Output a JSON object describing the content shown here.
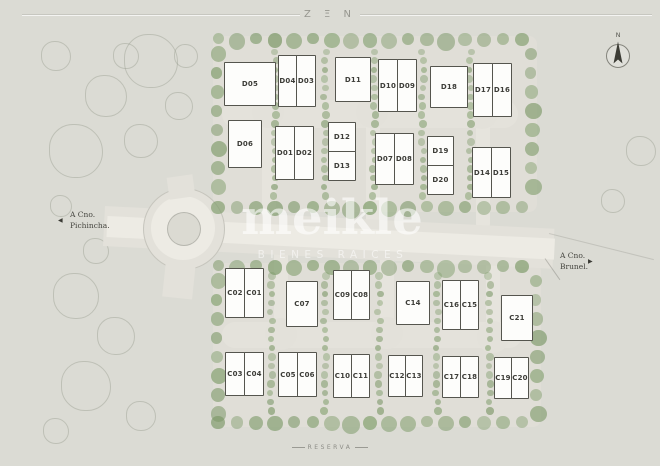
{
  "frame": {
    "top_title": "Z Ξ N",
    "bottom_title": "RESERVA"
  },
  "watermark": {
    "name": "meikle",
    "tagline": "BIENES RAICES"
  },
  "roads": {
    "west": {
      "line1": "A Cno.",
      "line2": "Pichincha.",
      "arrow": "◀"
    },
    "east": {
      "line1": "A Cno.",
      "line2": "Brunel.",
      "arrow": "▶"
    }
  },
  "compass": {
    "label": "N"
  },
  "colors": {
    "background": "#dbdbd4",
    "block": "#e0ded7",
    "road": "#edebe4",
    "tree": "#96a37c",
    "house_fill": "#fdfdfb",
    "house_stroke": "#55554e",
    "text": "#45453f",
    "watermark": "#ffffff"
  },
  "lots": {
    "d": [
      {
        "label": "D05",
        "x": 224,
        "y": 62,
        "w": 52,
        "h": 44
      },
      {
        "label": "D04",
        "x": 278,
        "y": 55,
        "w": 19,
        "h": 52
      },
      {
        "label": "D03",
        "x": 296,
        "y": 55,
        "w": 20,
        "h": 52
      },
      {
        "label": "D11",
        "x": 335,
        "y": 57,
        "w": 36,
        "h": 45
      },
      {
        "label": "D10",
        "x": 378,
        "y": 59,
        "w": 20,
        "h": 53
      },
      {
        "label": "D09",
        "x": 397,
        "y": 59,
        "w": 20,
        "h": 53
      },
      {
        "label": "D18",
        "x": 430,
        "y": 66,
        "w": 38,
        "h": 42
      },
      {
        "label": "D17",
        "x": 473,
        "y": 63,
        "w": 20,
        "h": 54
      },
      {
        "label": "D16",
        "x": 492,
        "y": 63,
        "w": 20,
        "h": 54
      },
      {
        "label": "D06",
        "x": 228,
        "y": 120,
        "w": 34,
        "h": 48
      },
      {
        "label": "D01",
        "x": 275,
        "y": 126,
        "w": 20,
        "h": 54
      },
      {
        "label": "D02",
        "x": 294,
        "y": 126,
        "w": 20,
        "h": 54
      },
      {
        "label": "D12",
        "x": 328,
        "y": 122,
        "w": 28,
        "h": 30
      },
      {
        "label": "D13",
        "x": 328,
        "y": 151,
        "w": 28,
        "h": 30
      },
      {
        "label": "D07",
        "x": 375,
        "y": 133,
        "w": 20,
        "h": 52
      },
      {
        "label": "D08",
        "x": 394,
        "y": 133,
        "w": 20,
        "h": 52
      },
      {
        "label": "D19",
        "x": 427,
        "y": 136,
        "w": 27,
        "h": 30
      },
      {
        "label": "D20",
        "x": 427,
        "y": 165,
        "w": 27,
        "h": 30
      },
      {
        "label": "D14",
        "x": 472,
        "y": 147,
        "w": 20,
        "h": 51
      },
      {
        "label": "D15",
        "x": 491,
        "y": 147,
        "w": 20,
        "h": 51
      }
    ],
    "c": [
      {
        "label": "C02",
        "x": 225,
        "y": 268,
        "w": 20,
        "h": 50
      },
      {
        "label": "C01",
        "x": 244,
        "y": 268,
        "w": 20,
        "h": 50
      },
      {
        "label": "C07",
        "x": 286,
        "y": 281,
        "w": 32,
        "h": 46
      },
      {
        "label": "C09",
        "x": 333,
        "y": 270,
        "w": 19,
        "h": 50
      },
      {
        "label": "C08",
        "x": 351,
        "y": 270,
        "w": 19,
        "h": 50
      },
      {
        "label": "C14",
        "x": 396,
        "y": 281,
        "w": 34,
        "h": 44
      },
      {
        "label": "C16",
        "x": 442,
        "y": 280,
        "w": 19,
        "h": 50
      },
      {
        "label": "C15",
        "x": 460,
        "y": 280,
        "w": 19,
        "h": 50
      },
      {
        "label": "C21",
        "x": 501,
        "y": 295,
        "w": 32,
        "h": 46
      },
      {
        "label": "C03",
        "x": 225,
        "y": 352,
        "w": 20,
        "h": 44
      },
      {
        "label": "C04",
        "x": 244,
        "y": 352,
        "w": 20,
        "h": 44
      },
      {
        "label": "C05",
        "x": 278,
        "y": 352,
        "w": 20,
        "h": 45
      },
      {
        "label": "C06",
        "x": 297,
        "y": 352,
        "w": 20,
        "h": 45
      },
      {
        "label": "C10",
        "x": 333,
        "y": 354,
        "w": 19,
        "h": 44
      },
      {
        "label": "C11",
        "x": 351,
        "y": 354,
        "w": 19,
        "h": 44
      },
      {
        "label": "C12",
        "x": 388,
        "y": 355,
        "w": 18,
        "h": 42
      },
      {
        "label": "C13",
        "x": 405,
        "y": 355,
        "w": 18,
        "h": 42
      },
      {
        "label": "C17",
        "x": 442,
        "y": 356,
        "w": 19,
        "h": 42
      },
      {
        "label": "C18",
        "x": 460,
        "y": 356,
        "w": 19,
        "h": 42
      },
      {
        "label": "C19",
        "x": 494,
        "y": 357,
        "w": 18,
        "h": 42
      },
      {
        "label": "C20",
        "x": 511,
        "y": 357,
        "w": 18,
        "h": 42
      }
    ]
  }
}
